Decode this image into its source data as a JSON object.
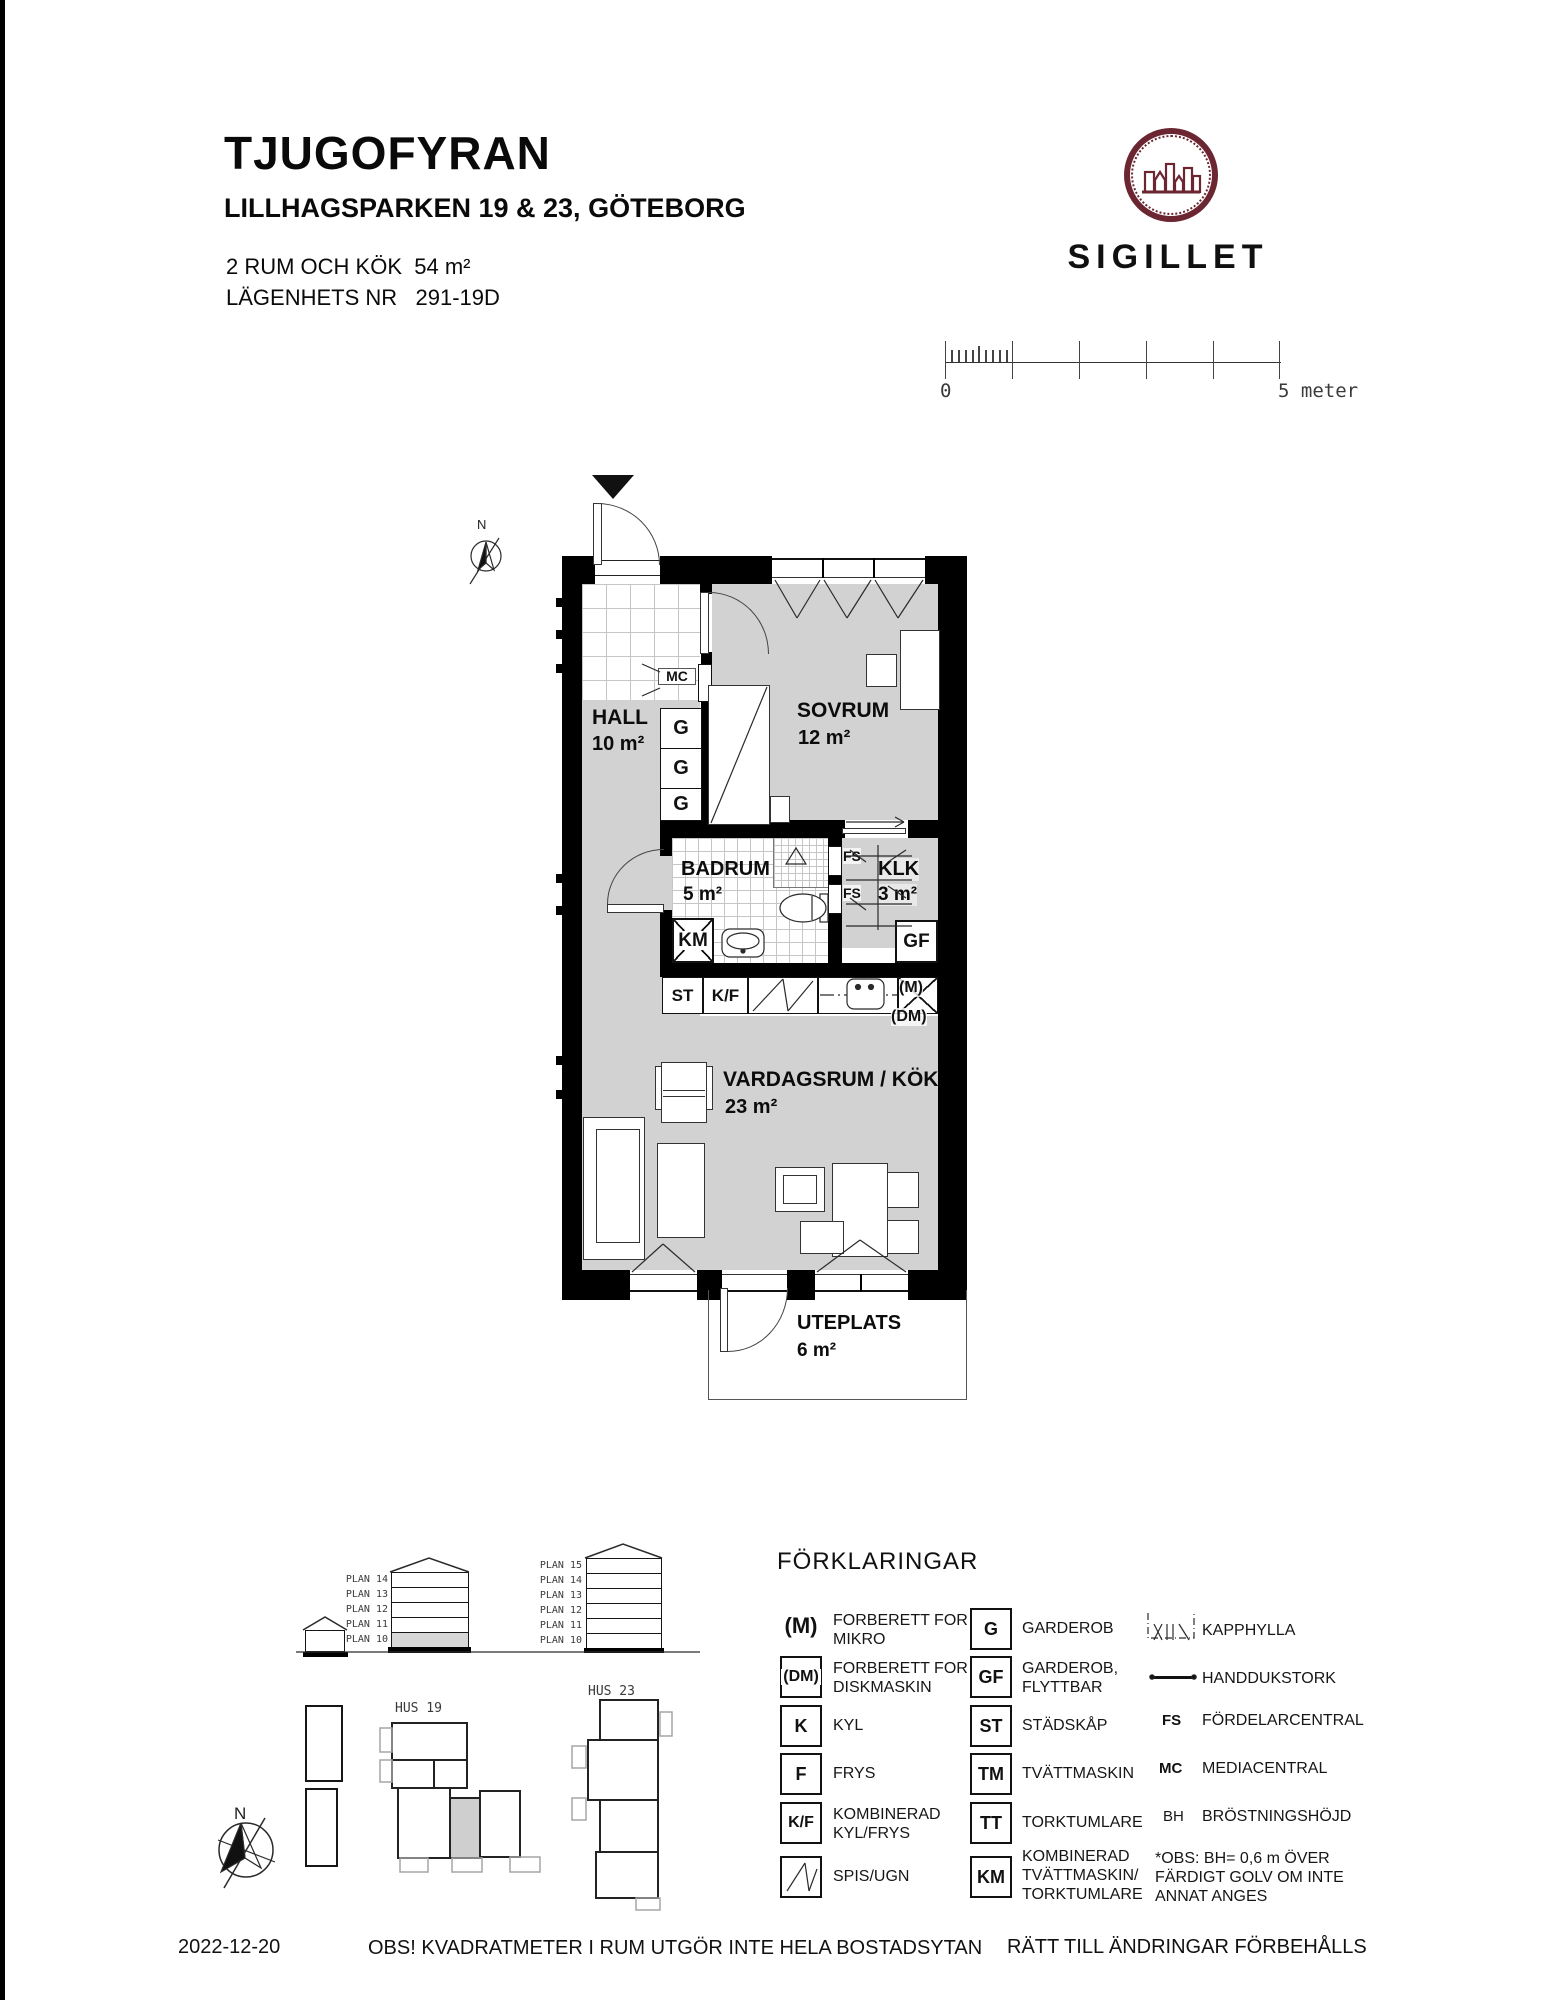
{
  "colors": {
    "wall": "#000000",
    "roomFill": "#d2d2d2",
    "tileLine": "#c6c6c6",
    "logoMaroon": "#6b2631",
    "line": "#2a2a2a"
  },
  "header": {
    "title": "TJUGOFYRAN",
    "address": "LILLHAGSPARKEN 19 & 23, GÖTEBORG",
    "size_line": "2 RUM OCH KÖK  54 m²",
    "apartment_line": "LÄGENHETS NR   291-19D"
  },
  "logo": {
    "name": "SIGILLET"
  },
  "scale_bar": {
    "start_label": "0",
    "end_label": "5 meter"
  },
  "compass": {
    "north_label": "N"
  },
  "rooms": [
    {
      "name": "HALL",
      "area": "10 m²"
    },
    {
      "name": "SOVRUM",
      "area": "12 m²"
    },
    {
      "name": "BADRUM",
      "area": "5 m²"
    },
    {
      "name": "KLK",
      "area": "3 m²"
    },
    {
      "name": "VARDAGSRUM / KÖK",
      "area": "23 m²"
    },
    {
      "name": "UTEPLATS",
      "area": "6 m²"
    }
  ],
  "plan_labels": {
    "mc": "MC",
    "g": "G",
    "fs": "FS",
    "gf": "GF",
    "km": "KM",
    "st": "ST",
    "kf": "K/F",
    "m": "(M)",
    "dm": "(DM)"
  },
  "elevations": {
    "hus19": {
      "plans": [
        "PLAN 14",
        "PLAN 13",
        "PLAN 12",
        "PLAN 11",
        "PLAN 10"
      ]
    },
    "hus23": {
      "plans": [
        "PLAN 15",
        "PLAN 14",
        "PLAN 13",
        "PLAN 12",
        "PLAN 11",
        "PLAN 10"
      ]
    }
  },
  "site": {
    "hus19_label": "HUS 19",
    "hus23_label": "HUS 23"
  },
  "legend": {
    "title": "FÖRKLARINGAR",
    "col1": [
      {
        "symbol": "(M)",
        "text": "FORBERETT FOR\nMIKRO"
      },
      {
        "symbol": "(DM)",
        "text": "FORBERETT FOR\nDISKMASKIN"
      },
      {
        "symbol": "K",
        "text": "KYL"
      },
      {
        "symbol": "F",
        "text": "FRYS"
      },
      {
        "symbol": "K/F",
        "text": "KOMBINERAD\nKYL/FRYS"
      },
      {
        "symbol": "",
        "text": "SPIS/UGN"
      }
    ],
    "col2": [
      {
        "symbol": "G",
        "text": "GARDEROB"
      },
      {
        "symbol": "GF",
        "text": "GARDEROB,\nFLYTTBAR"
      },
      {
        "symbol": "ST",
        "text": "STÄDSKÅP"
      },
      {
        "symbol": "TM",
        "text": "TVÄTTMASKIN"
      },
      {
        "symbol": "TT",
        "text": "TORKTUMLARE"
      },
      {
        "symbol": "KM",
        "text": "KOMBINERAD\nTVÄTTMASKIN/\nTORKTUMLARE"
      }
    ],
    "col3": [
      {
        "symbol": "",
        "text": "KAPPHYLLA"
      },
      {
        "symbol": "",
        "text": "HANDDUKSTORK"
      },
      {
        "symbol": "FS",
        "text": "FÖRDELARCENTRAL"
      },
      {
        "symbol": "MC",
        "text": "MEDIACENTRAL"
      },
      {
        "symbol": "BH",
        "text": "BRÖSTNINGSHÖJD"
      },
      {
        "symbol": "",
        "text": "*OBS: BH= 0,6 m ÖVER\nFÄRDIGT GOLV OM INTE\nANNAT ANGES"
      }
    ]
  },
  "footer": {
    "date": "2022-12-20",
    "note": "OBS! KVADRATMETER I RUM UTGÖR INTE HELA BOSTADSYTAN",
    "rights": "RÄTT TILL ÄNDRINGAR FÖRBEHÅLLS"
  }
}
